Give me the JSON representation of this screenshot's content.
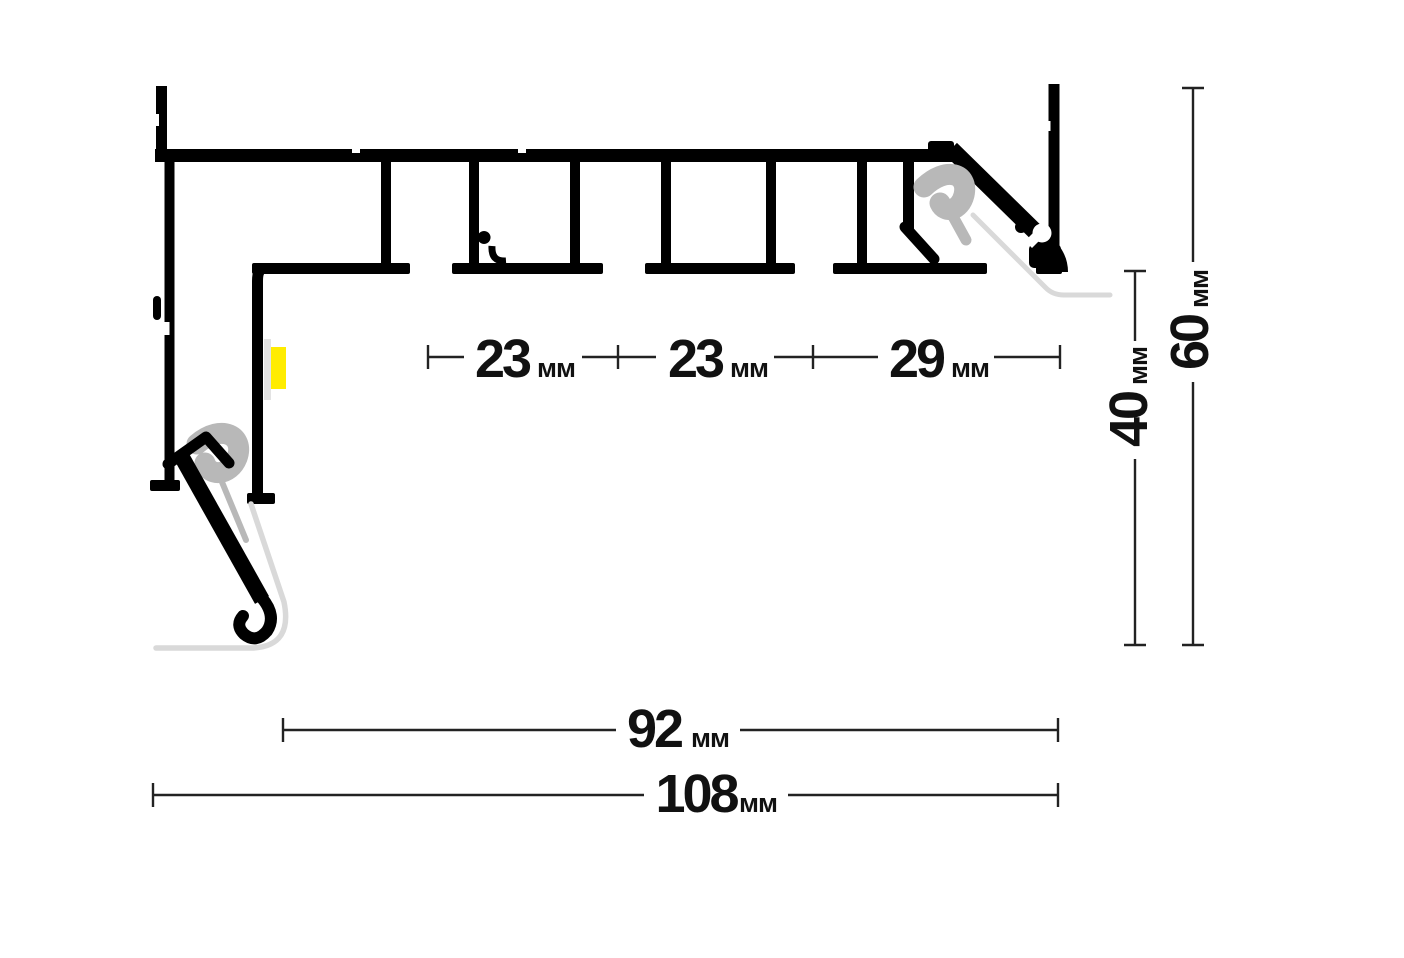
{
  "drawing": {
    "kind": "aluminium-profile-cross-section"
  },
  "unit": "мм",
  "dims": {
    "w23a": "23",
    "w23b": "23",
    "w29": "29",
    "h40": "40",
    "h60": "60",
    "w92": "92",
    "w108": "108"
  },
  "colors": {
    "profile": "#000000",
    "spring_clip": "#b8b8b8",
    "shadow_outline": "#d9d9d9",
    "led_strip": "#ffec00",
    "led_base": "#e3e3e3",
    "dimension_line": "#222222",
    "text": "#111111",
    "background": "#ffffff"
  }
}
